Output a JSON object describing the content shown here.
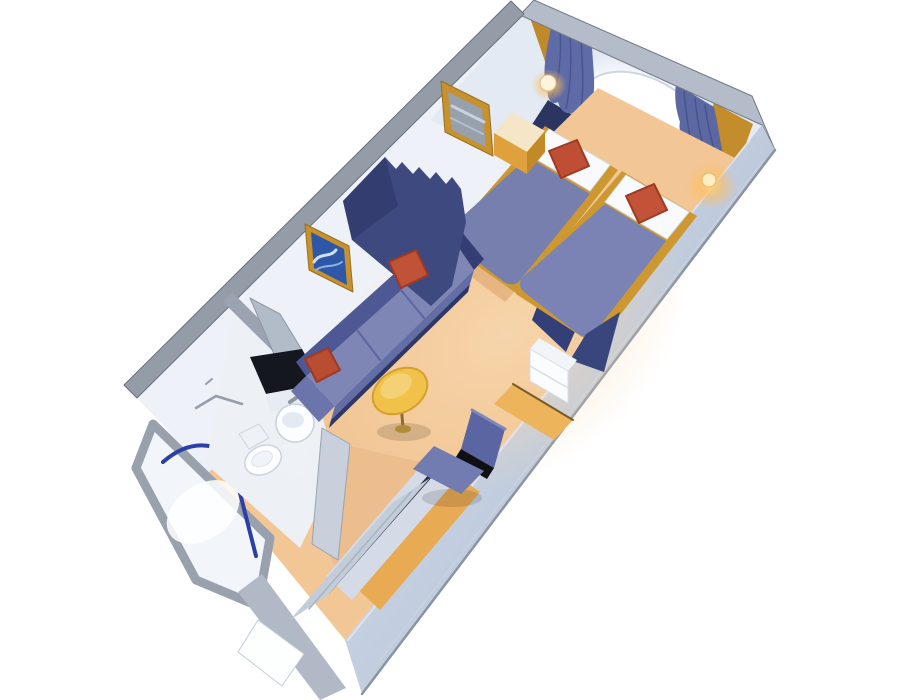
{
  "scene": {
    "description": "3D cutaway isometric rendering of a cruise ship interior stateroom floor plan with twin beds, window with curtains, sofa, table, desk chair, bathroom with shower, and entry closet",
    "width": 900,
    "height": 700,
    "background": "#ffffff"
  },
  "palette": {
    "carpet": "#f2c695",
    "carpet_corridor": "#ecbd8d",
    "wall_interior": "#eef2f8",
    "wall_cap_gray": "#949ca7",
    "wall_exterior": "#c5d0e1",
    "gold_trim": "#cd9832",
    "navy_headboard": "#2b355f",
    "bed_blanket": "#7a83b3",
    "pillow_white": "#f8fafd",
    "accent_red": "#c05238",
    "curtain_blue": "#5f6ba6",
    "divider_navy": "#3e4980",
    "sofa_blue": "#7d86b4",
    "table_yellow": "#f1c24a",
    "chair_blue": "#737cb1",
    "artwork_blue": "#2f57a8",
    "shower_frame_blue": "#2c3fa6",
    "sconce_glow": "#ffd27a"
  },
  "objects": [
    {
      "name": "left-wall-face",
      "type": "polygon",
      "points": "524,14 137,398 208,473 598,88",
      "fill": "#eef2f8"
    },
    {
      "name": "back-wall-face",
      "type": "polygon",
      "points": "520,15 762,124 700,252 430,120",
      "fill": "#e3eaf4"
    },
    {
      "name": "window-glow",
      "type": "ellipse",
      "cx": 643,
      "cy": 125,
      "rx": 92,
      "ry": 62,
      "rotate": 30,
      "fill": "url(#gOval)"
    },
    {
      "name": "window-oval",
      "type": "ellipse",
      "cx": 644,
      "cy": 124,
      "rx": 70,
      "ry": 45,
      "rotate": 30,
      "fill": "#ffffff",
      "stroke": "#cdd6e2",
      "sw": 2
    },
    {
      "name": "window-gold-trim",
      "type": "path",
      "d": "M 598,160 Q 644,178 692,166",
      "stroke": "#c59133",
      "sw": 3
    },
    {
      "name": "headboard-panel",
      "type": "polygon",
      "points": "548,100 714,201 684,248 518,146",
      "fill": "#2b355f"
    },
    {
      "name": "gold-panel-left",
      "type": "polygon",
      "points": "528,12 556,29 590,124 561,108",
      "fill": "#c08a2b"
    },
    {
      "name": "gold-panel-right",
      "type": "polygon",
      "points": "714,103 753,124 718,222 680,196",
      "fill": "#c28d2a"
    },
    {
      "name": "curtain-left",
      "type": "path",
      "d": "M 553,18 L 592,41 C 592,66 598,88 590,112 C 586,124 578,120 574,112 C 566,116 560,110 558,102 C 552,106 546,98 548,88 C 542,78 544,60 553,18 Z",
      "fill": "#5f6ba6"
    },
    {
      "name": "curtain-left-pleat-1",
      "type": "path",
      "d": "M 560,28 C 562,60 558,86 552,96",
      "stroke": "#49558e",
      "sw": 1.5
    },
    {
      "name": "curtain-left-pleat-2",
      "type": "path",
      "d": "M 570,34 C 572,64 570,92 566,108",
      "stroke": "#49558e",
      "sw": 1.5
    },
    {
      "name": "curtain-left-pleat-3",
      "type": "path",
      "d": "M 581,39 C 583,70 584,96 580,114",
      "stroke": "#49558e",
      "sw": 1.5
    },
    {
      "name": "curtain-right",
      "type": "path",
      "d": "M 676,84 L 714,107 C 718,124 720,142 724,158 C 714,162 708,152 704,148 C 696,154 690,146 690,138 C 682,140 678,130 680,122 C 676,110 674,98 676,84 Z",
      "fill": "#5c68a2"
    },
    {
      "name": "curtain-right-pleat-1",
      "type": "path",
      "d": "M 684,92 C 686,112 688,130 692,146",
      "stroke": "#47538c",
      "sw": 1.5
    },
    {
      "name": "curtain-right-pleat-2",
      "type": "path",
      "d": "M 695,99 C 697,118 700,134 704,150",
      "stroke": "#47538c",
      "sw": 1.5
    },
    {
      "name": "curtain-right-pleat-3",
      "type": "path",
      "d": "M 705,105 C 707,122 711,138 715,152",
      "stroke": "#47538c",
      "sw": 1.5
    },
    {
      "name": "back-wall-cap",
      "type": "polygon",
      "points": "534,0 752,96 775,150 762,125 520,15",
      "fill": "#b3bcc8",
      "stroke": "#727a85",
      "sw": 1
    },
    {
      "name": "left-wall-cap",
      "type": "polygon",
      "points": "524,14 137,398 124,385 511,1",
      "fill": "#949ca7",
      "stroke": "#6a717c",
      "sw": 1
    },
    {
      "name": "right-wall-exterior",
      "type": "polygon",
      "points": "762,125 775,150 362,694 345,640",
      "fill": "url(#gRwall)"
    },
    {
      "name": "right-wall-outer-edge",
      "type": "line",
      "x1": 775,
      "y1": 150,
      "x2": 362,
      "y2": 694,
      "stroke": "#8b94a1",
      "sw": 2.5
    },
    {
      "name": "right-wall-inner-edge",
      "type": "line",
      "x1": 750,
      "y1": 140,
      "x2": 348,
      "y2": 640,
      "stroke": "#dde4ee",
      "sw": 2
    },
    {
      "name": "right-wall-seam",
      "type": "line",
      "x1": 764,
      "y1": 160,
      "x2": 380,
      "y2": 660,
      "stroke": "#cbd4e1",
      "sw": 1
    },
    {
      "name": "floor-carpet",
      "type": "polygon",
      "points": "598,88 735,158 345,640 208,473",
      "fill": "#f2c695"
    },
    {
      "name": "floor-light-wash",
      "type": "ellipse",
      "cx": 505,
      "cy": 335,
      "rx": 200,
      "ry": 140,
      "rotate": -35,
      "fill": "url(#gFloor)",
      "opacity": 0.55
    },
    {
      "name": "carpet-shadow-beds",
      "type": "polygon",
      "points": "452,242 516,290 505,302 441,254",
      "fill": "#d9a067",
      "opacity": 0.55
    },
    {
      "name": "carpet-shadow-sofa",
      "type": "polygon",
      "points": "466,286 331,420 326,428 461,294",
      "fill": "#d9a067",
      "opacity": 0.5
    },
    {
      "name": "shower-stall-walls",
      "type": "polygon",
      "points": "153,424 136,468 196,580 258,606 270,538",
      "fill": "#f2f6fb",
      "stroke": "#98a1ac",
      "sw": 9
    },
    {
      "name": "shower-tray",
      "type": "ellipse",
      "cx": 203,
      "cy": 512,
      "rx": 40,
      "ry": 27,
      "rotate": -35,
      "fill": "#ffffff",
      "opacity": 0.85
    },
    {
      "name": "shower-glass-arc",
      "type": "path",
      "d": "M 163,462 Q 212,419 264,487",
      "stroke": "#2c3fa6",
      "sw": 4
    },
    {
      "name": "shower-door-bar",
      "type": "line",
      "x1": 228,
      "y1": 446,
      "x2": 256,
      "y2": 556,
      "stroke": "#2c3fa6",
      "sw": 4
    },
    {
      "name": "bathroom-floor",
      "type": "polygon",
      "points": "235,307 315,392 338,470 300,548 206,464",
      "fill": "#edf1f6"
    },
    {
      "name": "bathroom-partition-cap",
      "type": "polygon",
      "points": "232,292 321,380 312,390 223,302",
      "fill": "#9aa3af"
    },
    {
      "name": "vanity-mirror",
      "type": "polygon",
      "points": "250,298 280,314 330,396 298,410",
      "fill": "#b2bbc8",
      "stroke": "#8d97a4",
      "sw": 1
    },
    {
      "name": "vanity-countertop",
      "type": "polygon",
      "points": "250,357 302,349 320,384 266,394",
      "fill": "#14171e"
    },
    {
      "name": "vanity-front",
      "type": "polygon",
      "points": "266,394 320,384 324,402 270,412",
      "fill": "#e7ecf3"
    },
    {
      "name": "sink-faucet",
      "type": "line",
      "x1": 290,
      "y1": 402,
      "x2": 296,
      "y2": 398,
      "stroke": "#8d96a2",
      "sw": 4
    },
    {
      "name": "sink-pedestal",
      "type": "polygon",
      "points": "285,438 307,438 303,474 281,472",
      "fill": "#eef2f7"
    },
    {
      "name": "sink-bowl",
      "type": "circle",
      "cx": 295,
      "cy": 423,
      "r": 19,
      "fill": "#fcfdff",
      "stroke": "#c9d1dd",
      "sw": 1.5
    },
    {
      "name": "sink-basin",
      "type": "ellipse",
      "cx": 293,
      "cy": 420,
      "rx": 11,
      "ry": 8,
      "fill": "#e4eaf2"
    },
    {
      "name": "toilet-tank",
      "type": "polygon",
      "points": "239,434 259,424 269,438 249,449",
      "fill": "#eef1f6",
      "stroke": "#ccd4de",
      "sw": 1
    },
    {
      "name": "toilet-bowl",
      "type": "ellipse",
      "cx": 263,
      "cy": 460,
      "rx": 19,
      "ry": 14,
      "rotate": -25,
      "fill": "#fdfdfe",
      "stroke": "#ccd4de",
      "sw": 1.5
    },
    {
      "name": "toilet-seat",
      "type": "ellipse",
      "cx": 262,
      "cy": 459,
      "rx": 11,
      "ry": 7,
      "rotate": -25,
      "fill": "#f0f4f8",
      "stroke": "#dde3ea",
      "sw": 1
    },
    {
      "name": "towel-bar",
      "type": "path",
      "d": "M 196,408 L 216,396 L 242,404",
      "stroke": "#949dab",
      "sw": 2.5
    },
    {
      "name": "towel-hook",
      "type": "line",
      "x1": 206,
      "y1": 384,
      "x2": 212,
      "y2": 379,
      "stroke": "#949dab",
      "sw": 2
    },
    {
      "name": "corridor-floor",
      "type": "polygon",
      "points": "350,446 420,462 352,600 324,545",
      "fill": "#ecbd8d"
    },
    {
      "name": "entry-door-frame",
      "type": "polygon",
      "points": "238,592 262,574 346,688 320,700",
      "fill": "#b0b9c5"
    },
    {
      "name": "entry-door",
      "type": "polygon",
      "points": "258,620 304,654 282,686 238,652",
      "fill": "#fdfefe",
      "stroke": "#c6cdd7",
      "sw": 1
    },
    {
      "name": "bathroom-stub-wall",
      "type": "polygon",
      "points": "322,428 350,444 338,560 312,544",
      "fill": "#c9d0dc",
      "stroke": "#9aa3af",
      "sw": 1
    },
    {
      "name": "counter-strip",
      "type": "polygon",
      "points": "448,470 480,492 380,610 352,584",
      "fill": "#e8ab54"
    },
    {
      "name": "closet-top",
      "type": "polygon",
      "points": "428,458 456,480 352,600 326,576",
      "fill": "#d4dbe6"
    },
    {
      "name": "closet-top-edge",
      "type": "line",
      "x1": 432,
      "y1": 474,
      "x2": 328,
      "y2": 592,
      "stroke": "#232a40",
      "sw": 4
    },
    {
      "name": "closet-doors",
      "type": "polygon",
      "points": "430,478 328,595 290,620 392,503",
      "fill": "#c3ccd9"
    },
    {
      "name": "closet-door-seam",
      "type": "line",
      "x1": 411,
      "y1": 492,
      "x2": 309,
      "y2": 609,
      "stroke": "#aab3c0",
      "sw": 1.5
    },
    {
      "name": "bed-left-base",
      "type": "polygon",
      "points": "545,126 618,170 520,296 444,242",
      "fill": "#cd9832"
    },
    {
      "name": "bed-left-pillow",
      "type": "polygon",
      "points": "549,129 610,165 590,191 529,155",
      "fill": "#f8fafd",
      "stroke": "#d8dfe9",
      "sw": 1
    },
    {
      "name": "bed-left-pillow-seam",
      "type": "line",
      "x1": 573,
      "y1": 143,
      "x2": 554,
      "y2": 169,
      "stroke": "#dde3ec",
      "sw": 2
    },
    {
      "name": "bed-left-blanket",
      "type": "path",
      "d": "M 528,157 L 590,194 L 521,279 Q 515,288 504,282 L 452,242 Q 445,236 450,228 Z",
      "fill": "#767fae"
    },
    {
      "name": "bed-left-foot-drape",
      "type": "polygon",
      "points": "548,278 588,302 566,352 532,320",
      "fill": "#333f78"
    },
    {
      "name": "bed-left-red-pillow",
      "type": "polygon",
      "points": "549,151 577,140 589,166 561,178",
      "fill": "#bf4f34",
      "stroke": "#9e3a22",
      "sw": 2
    },
    {
      "name": "bed-right-base",
      "type": "polygon",
      "points": "622,171 697,216 596,346 516,294",
      "fill": "#cd9832"
    },
    {
      "name": "bed-right-pillow",
      "type": "polygon",
      "points": "626,175 689,212 667,239 605,202",
      "fill": "#f8fafd",
      "stroke": "#d8dfe9",
      "sw": 1
    },
    {
      "name": "bed-right-pillow-seam",
      "type": "line",
      "x1": 650,
      "y1": 188,
      "x2": 632,
      "y2": 214,
      "stroke": "#dde3ec",
      "sw": 2
    },
    {
      "name": "bed-right-blanket",
      "type": "path",
      "d": "M 605,204 L 666,241 L 595,332 Q 589,341 578,334 L 524,292 Q 517,286 522,278 Z",
      "fill": "#7a83b3"
    },
    {
      "name": "bed-right-foot-drape",
      "type": "polygon",
      "points": "586,334 620,312 604,372 570,360",
      "fill": "#39467e"
    },
    {
      "name": "bed-right-red-pillow",
      "type": "polygon",
      "points": "626,196 654,184 667,210 639,223",
      "fill": "#c25338",
      "stroke": "#9e3a22",
      "sw": 2
    },
    {
      "name": "nightstand-top",
      "type": "polygon",
      "points": "512,112 545,131 527,152 494,133",
      "fill": "#f5e6c8"
    },
    {
      "name": "nightstand-front",
      "type": "polygon",
      "points": "494,133 527,152 527,174 494,155",
      "fill": "#dfa13b"
    },
    {
      "name": "nightstand-side",
      "type": "polygon",
      "points": "527,152 545,131 545,152 527,174",
      "fill": "#c18a27"
    },
    {
      "name": "wall-mirror-frame",
      "type": "polygon",
      "points": "441,81 489,105 493,156 445,132",
      "fill": "#c6922d",
      "stroke": "#9a6f1e",
      "sw": 1
    },
    {
      "name": "wall-mirror-glass",
      "type": "polygon",
      "points": "448,92 482,109 486,147 452,130",
      "fill": "#97a0ad"
    },
    {
      "name": "wall-mirror-stripe-1",
      "type": "line",
      "x1": 452,
      "y1": 106,
      "x2": 484,
      "y2": 122,
      "stroke": "#c8d0da",
      "sw": 3
    },
    {
      "name": "wall-mirror-stripe-2",
      "type": "line",
      "x1": 451,
      "y1": 118,
      "x2": 483,
      "y2": 134,
      "stroke": "#b4bdc9",
      "sw": 2
    },
    {
      "name": "picture-frame",
      "type": "polygon",
      "points": "305,224 349,246 353,292 309,270",
      "fill": "#c6922d",
      "stroke": "#9a6f1e",
      "sw": 1
    },
    {
      "name": "picture-artwork",
      "type": "polygon",
      "points": "311,232 344,249 347,285 314,268",
      "fill": "#2f57a8"
    },
    {
      "name": "picture-wave-1",
      "type": "path",
      "d": "M 314,262 C 320,252 330,258 336,250",
      "stroke": "#cfe0f2",
      "sw": 3
    },
    {
      "name": "picture-wave-2",
      "type": "path",
      "d": "M 316,270 C 324,264 334,268 342,262",
      "stroke": "#8fb3e0",
      "sw": 2
    },
    {
      "name": "sofa-back",
      "type": "polygon",
      "points": "445,228 296,362 306,376 455,242",
      "fill": "#4e5894"
    },
    {
      "name": "sofa-seat",
      "type": "polygon",
      "points": "455,242 474,270 335,406 306,376",
      "fill": "#7d86b4"
    },
    {
      "name": "sofa-seam-1",
      "type": "line",
      "x1": 401,
      "y1": 290,
      "x2": 424,
      "y2": 318,
      "stroke": "#5c66a2",
      "sw": 2
    },
    {
      "name": "sofa-seam-2",
      "type": "line",
      "x1": 357,
      "y1": 330,
      "x2": 380,
      "y2": 360,
      "stroke": "#5c66a2",
      "sw": 2
    },
    {
      "name": "sofa-front",
      "type": "polygon",
      "points": "474,270 335,406 331,420 470,284",
      "fill": "#636da6"
    },
    {
      "name": "sofa-base-shadow",
      "type": "polygon",
      "points": "470,284 331,420 329,428 468,292",
      "fill": "#2e3766"
    },
    {
      "name": "sofa-arm-left",
      "type": "polygon",
      "points": "306,376 335,406 319,422 291,391",
      "fill": "#6b74ab"
    },
    {
      "name": "sofa-arm-right",
      "type": "polygon",
      "points": "445,228 455,242 474,270 484,259 457,226",
      "fill": "#343e74"
    },
    {
      "name": "divider-curtain",
      "type": "path",
      "d": "M 385,157 L 396,169 L 402,162 L 413,174 L 419,167 L 430,179 L 436,172 L 446,184 L 452,177 L 461,189 L 466,222 L 452,286 L 431,306 L 352,240 L 343,201 Z",
      "fill": "#3e4980"
    },
    {
      "name": "divider-curtain-shade",
      "type": "path",
      "d": "M 385,157 L 343,201 L 352,240 L 398,206 Z",
      "fill": "#333d6f"
    },
    {
      "name": "sofa-red-pillow-right",
      "type": "polygon",
      "points": "389,262 416,250 428,275 401,288",
      "fill": "#c05238",
      "stroke": "#9e3a22",
      "sw": 2
    },
    {
      "name": "sofa-red-pillow-left",
      "type": "polygon",
      "points": "305,359 328,348 340,370 317,382",
      "fill": "#b94d31",
      "stroke": "#9e3a22",
      "sw": 2
    },
    {
      "name": "table-shadow",
      "type": "ellipse",
      "cx": 404,
      "cy": 432,
      "rx": 27,
      "ry": 9,
      "fill": "#000000",
      "opacity": 0.13
    },
    {
      "name": "table-leg",
      "type": "line",
      "x1": 401,
      "y1": 404,
      "x2": 403,
      "y2": 428,
      "stroke": "#8a6d2f",
      "sw": 3
    },
    {
      "name": "table-base",
      "type": "ellipse",
      "cx": 403,
      "cy": 429,
      "rx": 8,
      "ry": 4,
      "fill": "#b08b3a"
    },
    {
      "name": "table-top",
      "type": "ellipse",
      "cx": 400,
      "cy": 391,
      "rx": 29,
      "ry": 21,
      "rotate": -30,
      "fill": "#f1c24a",
      "stroke": "#d3a02e",
      "sw": 2
    },
    {
      "name": "table-top-highlight",
      "type": "ellipse",
      "cx": 396,
      "cy": 386,
      "rx": 17,
      "ry": 11,
      "rotate": -30,
      "fill": "#f6d47c",
      "opacity": 0.85
    },
    {
      "name": "desk-top",
      "type": "polygon",
      "points": "494,404 554,440 573,420 513,384",
      "fill": "#edb45c"
    },
    {
      "name": "desk-wall-edge",
      "type": "line",
      "x1": 513,
      "y1": 384,
      "x2": 573,
      "y2": 420,
      "stroke": "#7a5a22",
      "sw": 2
    },
    {
      "name": "cabinet-top",
      "type": "polygon",
      "points": "530,349 568,371 577,360 539,338",
      "fill": "#f1f4f8"
    },
    {
      "name": "cabinet-front",
      "type": "polygon",
      "points": "530,349 568,371 568,403 530,381",
      "fill": "#fbfcfe",
      "stroke": "#d7dde6",
      "sw": 1
    },
    {
      "name": "cabinet-drawer-seam",
      "type": "line",
      "x1": 530,
      "y1": 366,
      "x2": 568,
      "y2": 388,
      "stroke": "#d7dde6",
      "sw": 1.5
    },
    {
      "name": "chair-shadow",
      "type": "ellipse",
      "cx": 452,
      "cy": 498,
      "rx": 30,
      "ry": 9,
      "fill": "#000000",
      "opacity": 0.12
    },
    {
      "name": "chair-backrest",
      "type": "polygon",
      "points": "472,410 505,429 494,468 461,449",
      "fill": "#5b65a2"
    },
    {
      "name": "chair-backrest-top",
      "type": "line",
      "x1": 472,
      "y1": 410,
      "x2": 505,
      "y2": 429,
      "stroke": "#7f88bb",
      "sw": 3
    },
    {
      "name": "chair-gap",
      "type": "polygon",
      "points": "461,449 494,468 487,479 454,460",
      "fill": "#0e1016"
    },
    {
      "name": "chair-seat",
      "type": "polygon",
      "points": "434,446 484,471 461,494 413,469",
      "fill": "#737cb1"
    },
    {
      "name": "sconce-left-glow",
      "type": "ellipse",
      "cx": 549,
      "cy": 85,
      "rx": 18,
      "ry": 16,
      "fill": "url(#gGlow)"
    },
    {
      "name": "sconce-left-lamp",
      "type": "circle",
      "cx": 548,
      "cy": 83,
      "r": 8,
      "fill": "#fdf4dd",
      "stroke": "#d9c18c",
      "sw": 1
    },
    {
      "name": "sconce-right-glow",
      "type": "ellipse",
      "cx": 711,
      "cy": 186,
      "rx": 26,
      "ry": 23,
      "fill": "url(#gGlow)"
    },
    {
      "name": "sconce-right-lamp",
      "type": "circle",
      "cx": 709,
      "cy": 180,
      "r": 7,
      "fill": "#ffeec2",
      "stroke": "#e2b96a",
      "sw": 1
    }
  ]
}
